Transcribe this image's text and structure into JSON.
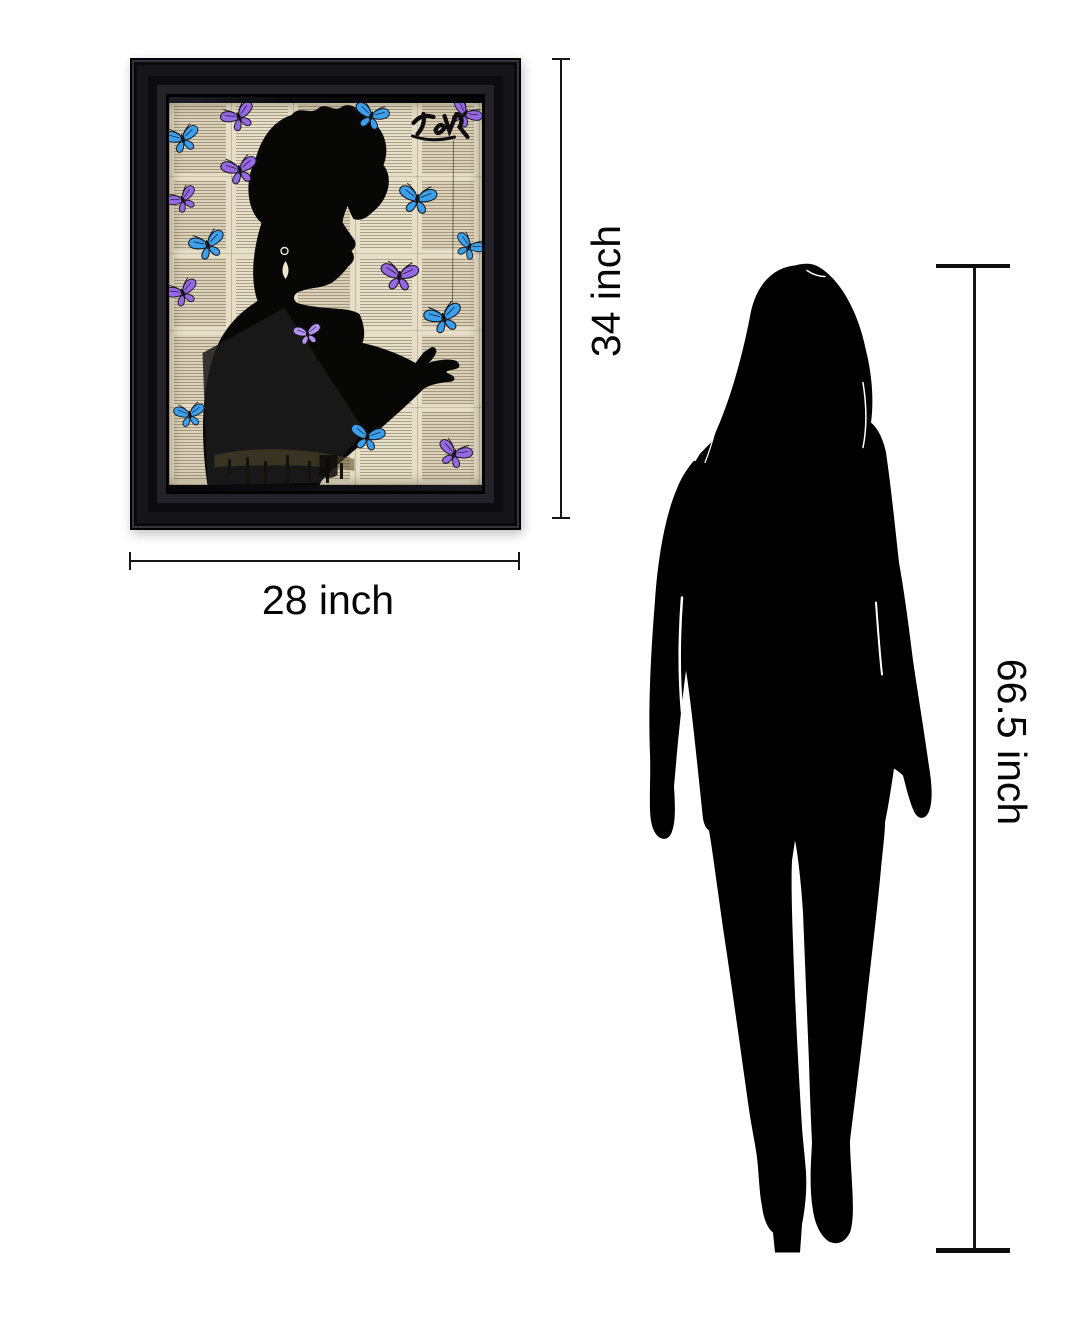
{
  "diagram": {
    "type": "product-size-comparison",
    "measurements": {
      "art_height": {
        "label": "34 inch"
      },
      "art_width": {
        "label": "28 inch"
      },
      "person_height": {
        "label": "66.5 inch"
      }
    }
  },
  "artwork": {
    "signature": "Jover",
    "frame_color": "#0b0b0e",
    "paper_color": "#e6dec6",
    "silhouette_color": "#070706",
    "butterfly_colors": {
      "blue": "#3aa0ee",
      "purple": "#9668e4",
      "light_purple": "#b494f0"
    },
    "butterflies": [
      {
        "x": 69,
        "y": 13,
        "color": "purple",
        "rot": -25,
        "scale": 1.0
      },
      {
        "x": 202,
        "y": 12,
        "color": "blue",
        "rot": 15,
        "scale": 1.0
      },
      {
        "x": 296,
        "y": 10,
        "color": "purple",
        "rot": 35,
        "scale": 0.95
      },
      {
        "x": 13,
        "y": 35,
        "color": "blue",
        "rot": -15,
        "scale": 1.0
      },
      {
        "x": 70,
        "y": 66,
        "color": "purple",
        "rot": -12,
        "scale": 1.05
      },
      {
        "x": 13,
        "y": 96,
        "color": "purple",
        "rot": -28,
        "scale": 0.9
      },
      {
        "x": 248,
        "y": 95,
        "color": "blue",
        "rot": 8,
        "scale": 1.1
      },
      {
        "x": 300,
        "y": 143,
        "color": "blue",
        "rot": 28,
        "scale": 0.9
      },
      {
        "x": 38,
        "y": 141,
        "color": "blue",
        "rot": -18,
        "scale": 1.05
      },
      {
        "x": 230,
        "y": 172,
        "color": "purple",
        "rot": 4,
        "scale": 1.1
      },
      {
        "x": 13,
        "y": 189,
        "color": "purple",
        "rot": -22,
        "scale": 0.95
      },
      {
        "x": 138,
        "y": 230,
        "color": "light_purple",
        "rot": -10,
        "scale": 0.8
      },
      {
        "x": 274,
        "y": 214,
        "color": "blue",
        "rot": -15,
        "scale": 1.1
      },
      {
        "x": 20,
        "y": 311,
        "color": "blue",
        "rot": -8,
        "scale": 0.9
      },
      {
        "x": 198,
        "y": 333,
        "color": "blue",
        "rot": 10,
        "scale": 1.0
      },
      {
        "x": 285,
        "y": 350,
        "color": "purple",
        "rot": 20,
        "scale": 1.0
      }
    ]
  },
  "person": {
    "silhouette_color": "#000000"
  }
}
